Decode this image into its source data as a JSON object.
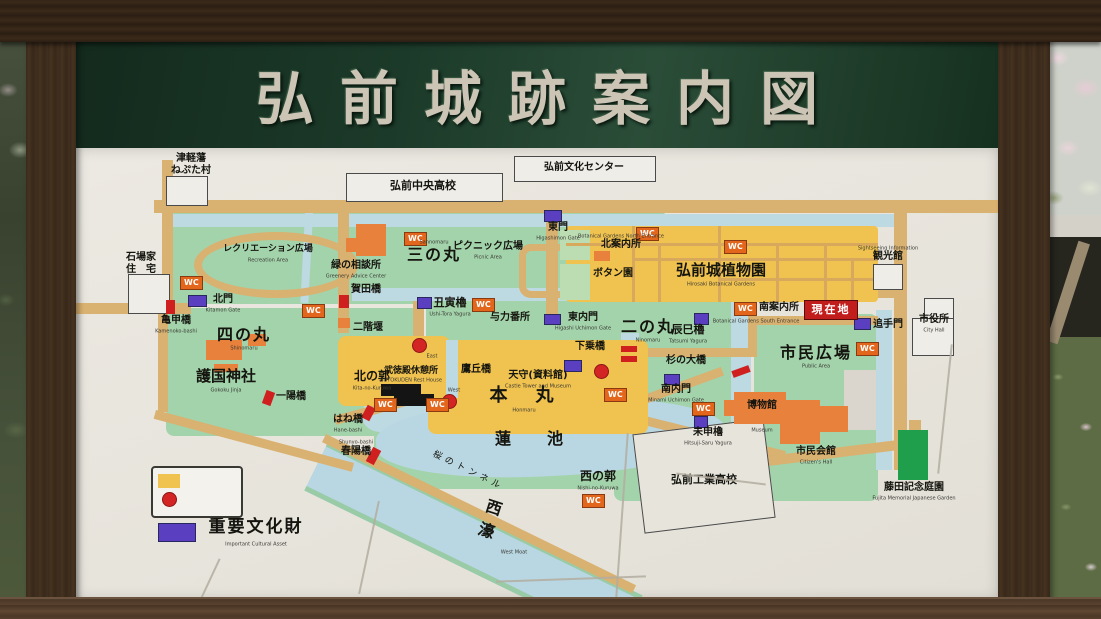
{
  "title": "弘前城跡案内図",
  "marker": {
    "wc": "WC"
  },
  "legend": {
    "pay_zone": {
      "label": "有料区域",
      "sub": "Pay zone"
    },
    "ticket_booth": {
      "label": "券売所",
      "sub": "Ticket Booth"
    },
    "cultural": {
      "label": "重要文化財",
      "sub": "Important Cultural Asset"
    }
  },
  "colors": {
    "pay_zone": "#f0c24f",
    "ticket": "#d42525",
    "cultural": "#5a3fc0",
    "road": "#d9b170",
    "park": "#a3d3ab",
    "moat": "#bdd9e2",
    "wc": "#e2661c",
    "you_are_here": "#c21d1d",
    "fujita_green": "#1f9e4b"
  },
  "places": {
    "neputa": {
      "label": "津軽藩\nねぷた村"
    },
    "chuo_hs": {
      "label": "弘前中央高校"
    },
    "bunka_center": {
      "label": "弘前文化センター"
    },
    "ishiba": {
      "label": "石場家\n住　宅"
    },
    "recreation": {
      "label": "レクリエーション広場",
      "sub": "Recreation Area"
    },
    "midori_sodanjo": {
      "label": "緑の相談所",
      "sub": "Greenery Advice Center"
    },
    "sannomaru": {
      "label": "三の丸",
      "sub": "Sannomaru"
    },
    "picnic": {
      "label": "ピクニック広場",
      "sub": "Picnic Area"
    },
    "kadabashi": {
      "label": "賀田橋"
    },
    "nikaizeki": {
      "label": "二階堰"
    },
    "kitamon": {
      "label": "北門",
      "sub": "Kitamon Gate"
    },
    "kamenokobashi": {
      "label": "亀甲橋",
      "sub": "Kamenoko-bashi"
    },
    "shinomaru": {
      "label": "四の丸",
      "sub": "Shinomaru"
    },
    "gokoku": {
      "label": "護国神社",
      "sub": "Gokoku Jinja"
    },
    "ichiyobashi": {
      "label": "一陽橋"
    },
    "ushitora": {
      "label": "丑寅櫓",
      "sub": "Ushi-Tora Yagura"
    },
    "yoriki": {
      "label": "与力番所"
    },
    "higashimon": {
      "label": "東門",
      "sub": "Higashimon Gate"
    },
    "higashi_uchimon": {
      "label": "東内門",
      "sub": "Higashi Uchimon Gate"
    },
    "ninomaru": {
      "label": "二の丸",
      "sub": "Ninomaru"
    },
    "tatsumi": {
      "label": "辰巳櫓",
      "sub": "Tatsumi Yagura"
    },
    "kita_annaijo": {
      "label": "北案内所",
      "sub": "Botanical Gardens North Entrance"
    },
    "botan_en": {
      "label": "ボタン園"
    },
    "botanical_garden": {
      "label": "弘前城植物園",
      "sub": "Hirosaki Botanical Gardens"
    },
    "minami_annaijo": {
      "label": "南案内所",
      "sub": "Botanical Gardens South Entrance"
    },
    "genzaichi": {
      "label": "現在地"
    },
    "otemon": {
      "label": "追手門"
    },
    "kankokan": {
      "label": "観光館",
      "sub": "Sightseeing Information"
    },
    "shiyakusho": {
      "label": "市役所",
      "sub": "City Hall"
    },
    "kita_no_kuruwa": {
      "label": "北の郭",
      "sub": "Kita-no-Kuruwa"
    },
    "butokuden": {
      "label": "武徳殿休憩所",
      "sub": "BUTOKUDEN Rest House"
    },
    "takaokabashi": {
      "label": "鷹丘橋"
    },
    "tenshu": {
      "label": "天守(資料館)",
      "sub": "Castle Tower and Museum"
    },
    "honmaru": {
      "label": "本　丸",
      "sub": "Honmaru"
    },
    "gejobashi": {
      "label": "下乗橋"
    },
    "east_booth": {
      "label": "East"
    },
    "west_booth": {
      "label": "West"
    },
    "sugi_no_ohashi": {
      "label": "杉の大橋"
    },
    "minami_uchimon": {
      "label": "南内門",
      "sub": "Minami Uchimon Gate"
    },
    "shimin_hiroba": {
      "label": "市民広場",
      "sub": "Public Area"
    },
    "hitsujisaru": {
      "label": "未申櫓",
      "sub": "Hitsuji-Saru Yagura"
    },
    "hakubutsukan": {
      "label": "博物館",
      "sub": "Museum"
    },
    "shimin_kaikan": {
      "label": "市民会館",
      "sub": "Citizen's Hall"
    },
    "hanebashi": {
      "label": "はね橋",
      "sub": "Hane-bashi"
    },
    "shunyobashi": {
      "label": "春陽橋",
      "sub": "Shunyo-bashi"
    },
    "hasuike": {
      "label": "蓮　池"
    },
    "sakura_tunnel": {
      "label": "桜のトンネル"
    },
    "nishi_no_kuruwa": {
      "label": "西の郭",
      "sub": "Nishi-no-Kuruwa"
    },
    "nishibori": {
      "label": "西\n濠",
      "sub": "West Moat"
    },
    "kogyo_hs": {
      "label": "弘前工業高校"
    },
    "fujita": {
      "label": "藤田記念庭園",
      "sub": "Fujita Memorial Japanese Garden"
    }
  }
}
